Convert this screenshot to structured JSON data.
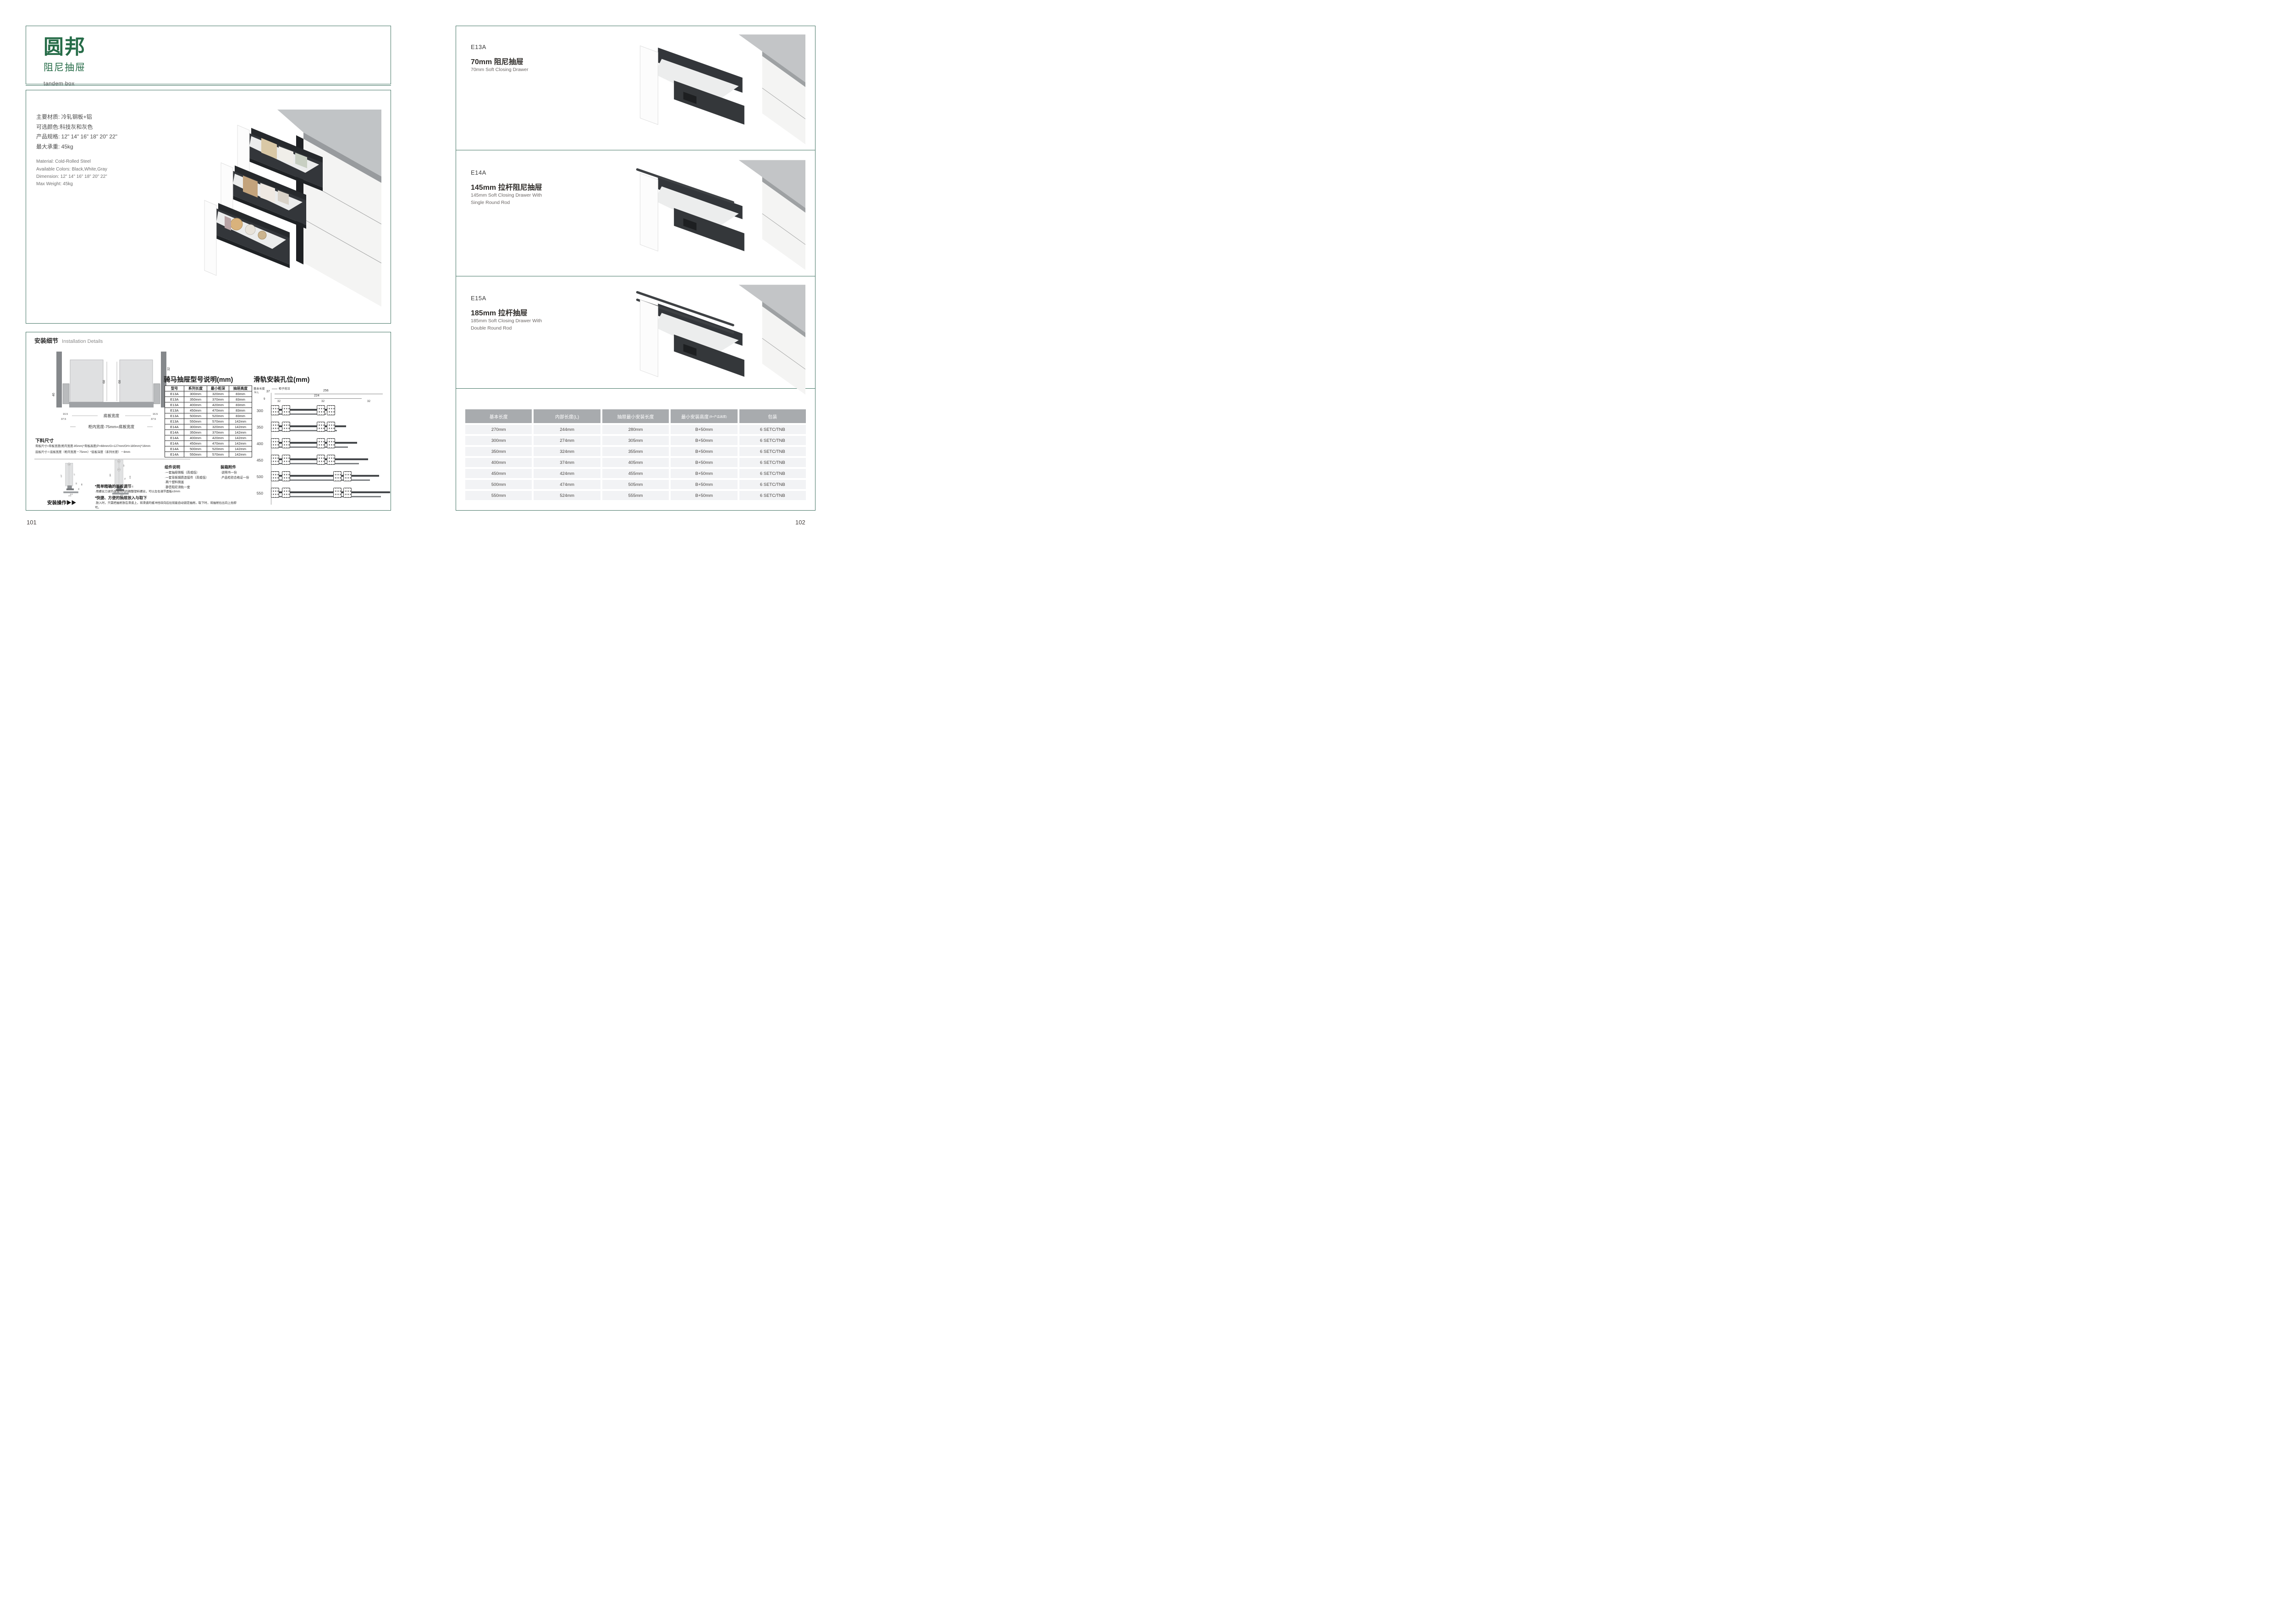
{
  "brand": {
    "name": "圆邦",
    "product": "阻尼抽屉",
    "tagline": "tandem box"
  },
  "specs": {
    "cn": [
      "主要材质: 冷轧钢板+铝",
      "可选颜色:科技灰和灰色",
      "产品规格: 12\" 14\" 16\" 18\" 20\" 22\"",
      "最大承重: 45kg"
    ],
    "en": [
      "Material: Cold-Rolled Steel",
      "Available Colors: Black,White,Gray",
      "Dimension: 12\" 14\" 16\" 18\" 20\" 22\"",
      "Max Weight: 45kg"
    ]
  },
  "installation": {
    "title_cn": "安装细节",
    "title_en": "Installation Details",
    "cross_section": {
      "dims": [
        "68",
        "68",
        "46",
        "32",
        "54",
        "16.5",
        "37.5",
        "16.5",
        "37.5"
      ],
      "bottom_label": "底板宽度",
      "formula": "柜内宽度-75mm=底板宽度"
    },
    "cutting": {
      "title": "下料尺寸",
      "lines": [
        "背板尺寸=背板宽度(柜内宽度-85mm)*背板高度(P=68mm/G=127mm/GH=180mm)*16mm",
        "底板尺寸＝底板宽度（柜内宽度－75mm）*底板深度（系列长度）－8mm"
      ]
    },
    "profile_low": {
      "dims": [
        "127",
        "77",
        "32",
        "86",
        "54",
        "16.5",
        "37.5"
      ]
    },
    "profile_high": {
      "dims": [
        "180",
        "57",
        "73",
        "130",
        "32",
        "86",
        "54",
        "16.5",
        "37.5"
      ]
    },
    "operation": {
      "label": "安装操作",
      "arrows": "▶▶",
      "notes": [
        {
          "head": "*简单精确的面板调节",
          "body": "·用螺丝刀调节连接件内的调整塑料螺丝，可以左右调节面板±3mm"
        },
        {
          "head": "*快捷、方便的抽屉放入与取下",
          "body": "·放入时，只需把抽屉放在滑道上，将滑道的缓冲挡块向后拉就能自动锁定抽屉。取下时，将抽屉拉出向上抬即可。"
        }
      ]
    },
    "model_table": {
      "title": "骑马抽屉型号说明(mm)",
      "headers": [
        "型号",
        "系列长度",
        "最小柜深",
        "抽屉高度"
      ],
      "rows": [
        [
          "E13A",
          "300mm",
          "320mm",
          "83mm"
        ],
        [
          "E13A",
          "350mm",
          "370mm",
          "83mm"
        ],
        [
          "E13A",
          "400mm",
          "420mm",
          "83mm"
        ],
        [
          "E13A",
          "450mm",
          "470mm",
          "83mm"
        ],
        [
          "E13A",
          "500mm",
          "520mm",
          "83mm"
        ],
        [
          "E13A",
          "550mm",
          "570mm",
          "142mm"
        ],
        [
          "E14A",
          "300mm",
          "320mm",
          "142mm"
        ],
        [
          "E14A",
          "350mm",
          "370mm",
          "142mm"
        ],
        [
          "E14A",
          "400mm",
          "420mm",
          "142mm"
        ],
        [
          "E14A",
          "450mm",
          "470mm",
          "142mm"
        ],
        [
          "E14A",
          "500mm",
          "520mm",
          "142mm"
        ],
        [
          "E14A",
          "550mm",
          "570mm",
          "142mm"
        ]
      ]
    },
    "components": {
      "title": "组件说明",
      "items": [
        "·一套抽屉侧板（高或低）",
        "·一套背板钢质连接件（高或低）",
        "·两个塑料侧盖",
        "·静音阻尼滑轨一套"
      ]
    },
    "packing": {
      "title": "装箱附件",
      "items": [
        "·说明书一份",
        "·产品检验合格证一份"
      ]
    },
    "rail_diagram": {
      "title": "滑轨安装孔位(mm)",
      "axis_cn": "基本长度",
      "axis_en": "N L",
      "front_label": "柜子前沿",
      "dim_overall": "256",
      "dim_inner": "224",
      "dim_front": "37",
      "dim_edge": "9",
      "dim_pitch": "32",
      "lengths": [
        "300",
        "350",
        "400",
        "450",
        "500",
        "550"
      ]
    }
  },
  "products": [
    {
      "code": "E13A",
      "name_cn": "70mm 阻尼抽屉",
      "name_en": "70mm Soft Closing Drawer"
    },
    {
      "code": "E14A",
      "name_cn": "145mm 拉杆阻尼抽屉",
      "name_en": "145mm Soft Closing Drawer With Single Round Rod"
    },
    {
      "code": "E15A",
      "name_cn": "185mm 拉杆抽屉",
      "name_en": "185mm Soft Closing Drawer With Double Round Rod"
    }
  ],
  "size_table": {
    "headers": [
      "基本长度",
      "内部长度(L)",
      "抽屉最小安装长度",
      "最小安装高度",
      "包装"
    ],
    "header_note": "(B=产品高度)",
    "rows": [
      [
        "270mm",
        "244mm",
        "280mm",
        "B+50mm",
        "6 SETC/TNB"
      ],
      [
        "300mm",
        "274mm",
        "305mm",
        "B+50mm",
        "6 SETC/TNB"
      ],
      [
        "350mm",
        "324mm",
        "355mm",
        "B+50mm",
        "6 SETC/TNB"
      ],
      [
        "400mm",
        "374mm",
        "405mm",
        "B+50mm",
        "6 SETC/TNB"
      ],
      [
        "450mm",
        "424mm",
        "455mm",
        "B+50mm",
        "6 SETC/TNB"
      ],
      [
        "500mm",
        "474mm",
        "505mm",
        "B+50mm",
        "6 SETC/TNB"
      ],
      [
        "550mm",
        "524mm",
        "555mm",
        "B+50mm",
        "6 SETC/TNB"
      ]
    ]
  },
  "pages": {
    "left": "101",
    "right": "102"
  },
  "colors": {
    "accent_green": "#266c48",
    "border_teal": "#447565",
    "table_header_bg": "#a8abae",
    "table_row_bg": "#f2f3f5"
  }
}
